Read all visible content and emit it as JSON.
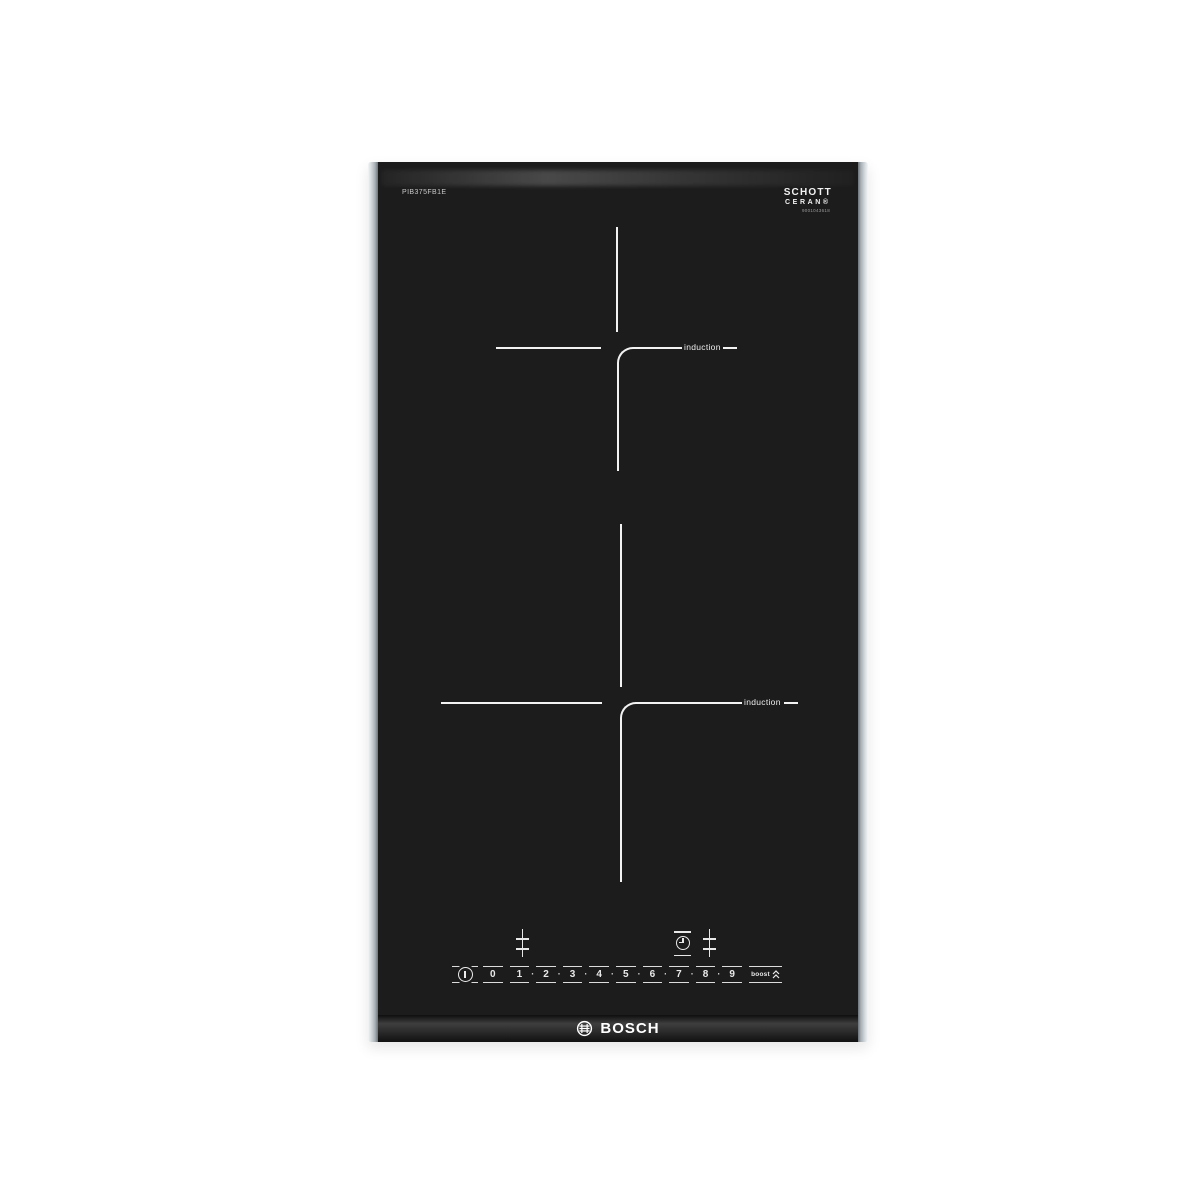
{
  "hob": {
    "model_number": "PIB375FB1E",
    "glass_brand": {
      "line1": "SCHOTT",
      "line2": "CERAN®",
      "code": "9001043618"
    },
    "brand_logo_text": "BOSCH",
    "zones": [
      {
        "id": "upper",
        "label": "induction"
      },
      {
        "id": "lower",
        "label": "induction"
      }
    ],
    "controls": {
      "levels": [
        "0",
        "1",
        "2",
        "3",
        "4",
        "5",
        "6",
        "7",
        "8",
        "9"
      ],
      "separator_dot": "·",
      "boost_label": "boost",
      "icons": {
        "power": "power-icon",
        "timer": "timer-clock-icon",
        "zone_left": "level-slider-icon",
        "zone_right": "level-slider-icon",
        "boost_chevrons": "double-chevron-up-icon"
      }
    },
    "colors": {
      "glass": "#1c1c1c",
      "markings": "#f2f2f2",
      "rail": "#c3c9cc",
      "background": "#ffffff"
    }
  }
}
